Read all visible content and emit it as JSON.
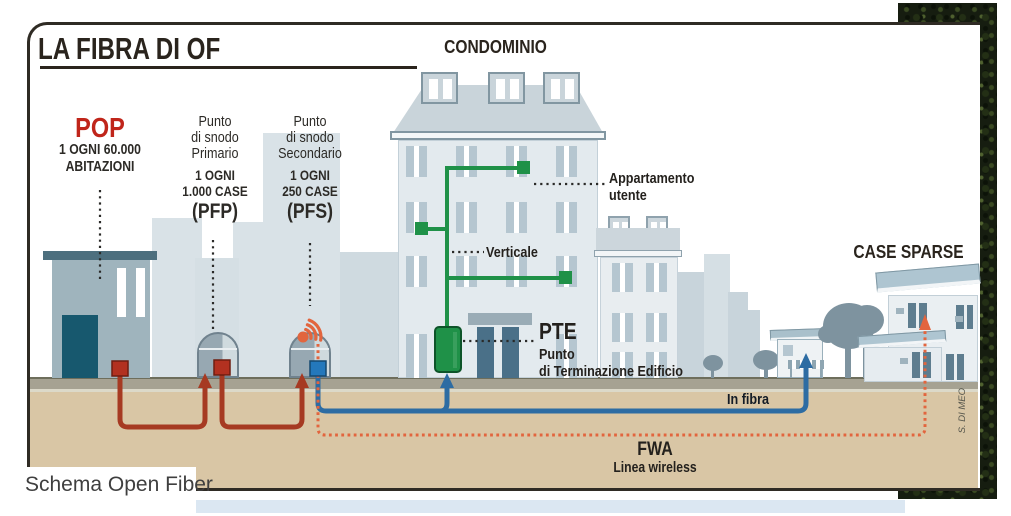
{
  "title": "LA FIBRA DI OF",
  "pop": {
    "name": "POP",
    "detail1": "1 OGNI 60.000",
    "detail2": "ABITAZIONI"
  },
  "pfp": {
    "line1": "Punto",
    "line2": "di snodo",
    "line3": "Primario",
    "bold1": "1 OGNI",
    "bold2": "1.000 CASE",
    "code": "(PFP)"
  },
  "pfs": {
    "line1": "Punto",
    "line2": "di snodo",
    "line3": "Secondario",
    "bold1": "1 OGNI",
    "bold2": "250 CASE",
    "code": "(PFS)"
  },
  "condominio": {
    "title": "CONDOMINIO",
    "apartment_line1": "Appartamento",
    "apartment_line2": "utente",
    "vertical": "Verticale"
  },
  "pte": {
    "code": "PTE",
    "line1": "Punto",
    "line2": "di Terminazione Edificio"
  },
  "case_sparse": {
    "title": "CASE SPARSE"
  },
  "connections": {
    "fiber_label": "In fibra",
    "fwa_title": "FWA",
    "fwa_subtitle": "Linea wireless"
  },
  "credit": "S. DI MEO",
  "caption": "Schema Open Fiber",
  "colors": {
    "pop_red": "#c0251a",
    "fiber_red": "#a63a22",
    "fiber_blue": "#2d6ca3",
    "fwa_orange": "#e2653e",
    "network_green": "#1f9148"
  }
}
